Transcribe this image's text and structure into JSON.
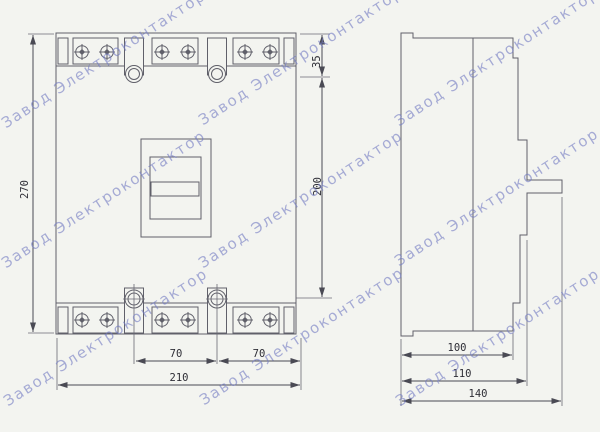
{
  "page": {
    "background": "#f3f4f0"
  },
  "watermark": {
    "text": "Завод Электроконтактор",
    "color": "#747cc4"
  },
  "drawing": {
    "line_color": "#60606a",
    "description": "circuit-breaker-two-view-dimension-drawing",
    "front_view": {
      "dims": {
        "overall_height": "270",
        "top_edge_to_hole": "35",
        "hole_span": "200",
        "hole_pitch_left": "70",
        "hole_pitch_right": "70",
        "overall_width": "210"
      }
    },
    "side_view": {
      "dims": {
        "body_depth": "100",
        "front_depth": "110",
        "overall_depth": "140"
      }
    }
  }
}
